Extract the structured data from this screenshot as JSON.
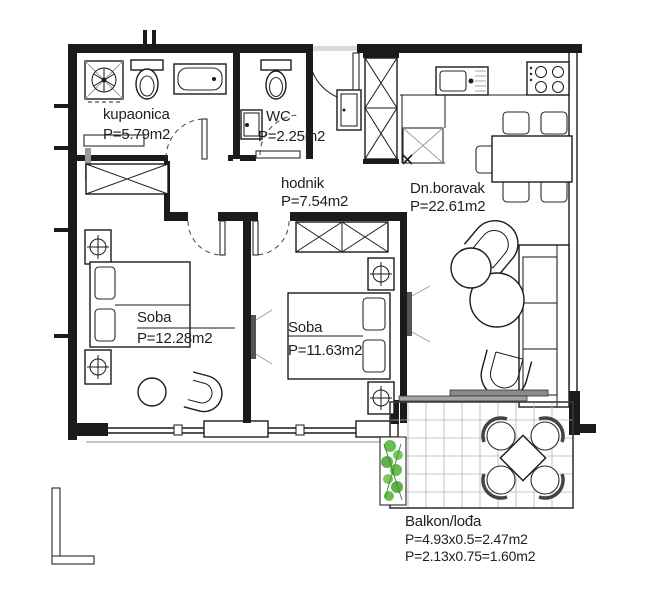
{
  "plan": {
    "rooms": {
      "kupaonica": {
        "name": "kupaonica",
        "area": "P=5.79m2"
      },
      "wc": {
        "name": "WC",
        "area": "P=2.25m2"
      },
      "hodnik": {
        "name": "hodnik",
        "area": "P=7.54m2"
      },
      "dnevni_boravak": {
        "name": "Dn.boravak",
        "area": "P=22.61m2"
      },
      "soba_1": {
        "name": "Soba",
        "area": "P=12.28m2"
      },
      "soba_2": {
        "name": "Soba",
        "area": "P=11.63m2"
      },
      "balkon": {
        "name": "Balkon/lođa",
        "area_1": "P=4.93x0.5=2.47m2",
        "area_2": "P=2.13x0.75=1.60m2"
      }
    },
    "colors": {
      "line": "#1b1b1b",
      "plant_green": "#5cb63e",
      "plant_green_dark": "#3f8f2c",
      "grid_gray": "#b5b5b5",
      "panel_gray": "#8a8a8a",
      "background": "#ffffff"
    }
  }
}
